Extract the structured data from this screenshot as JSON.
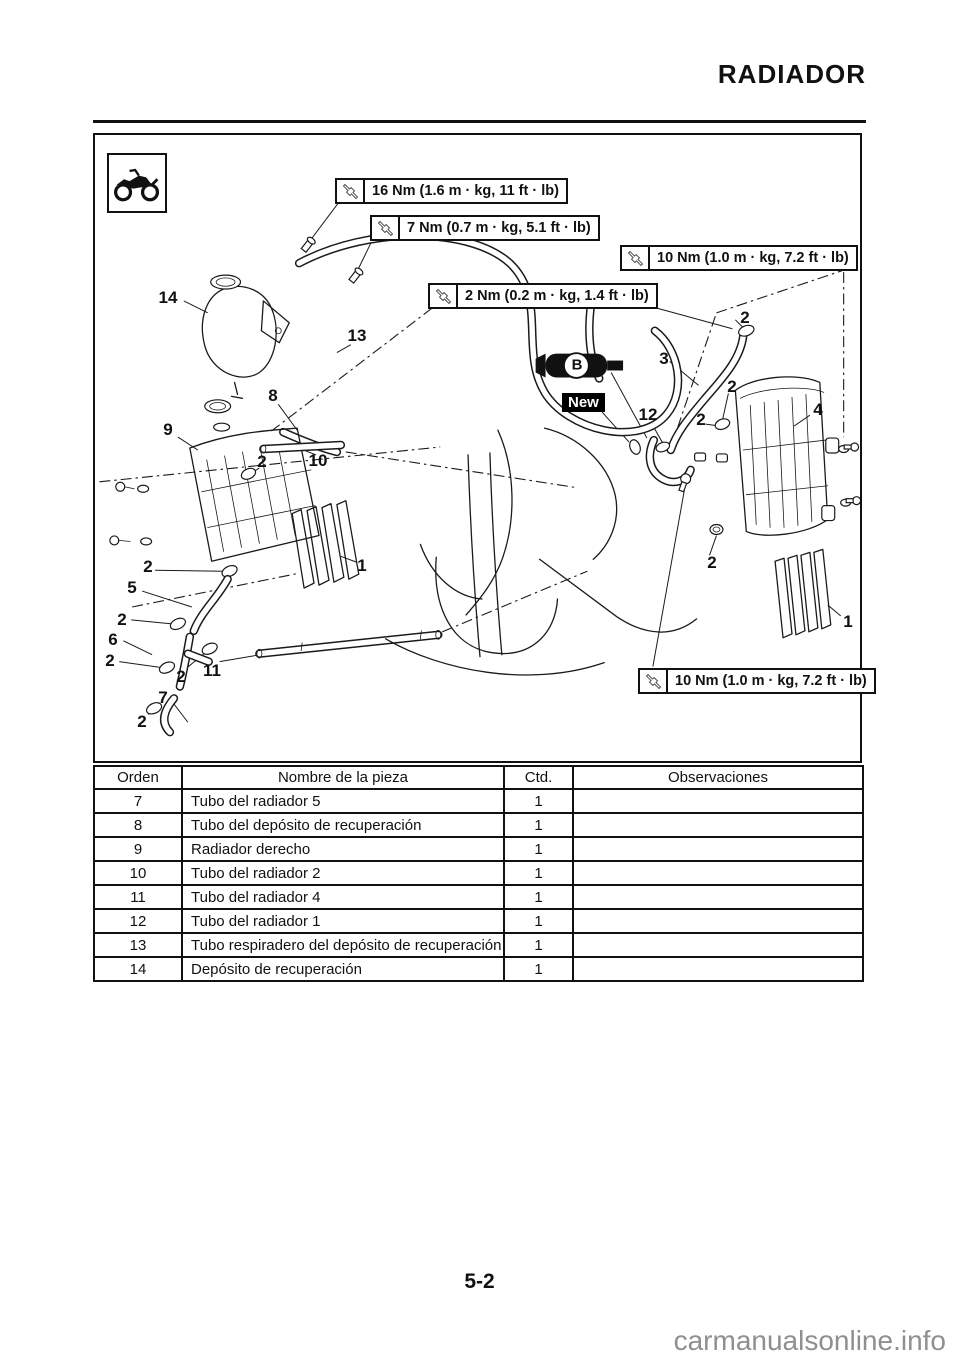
{
  "page": {
    "title": "RADIADOR",
    "number": "5-2",
    "watermark": "carmanualsonline.info"
  },
  "colors": {
    "ink": "#111111",
    "watermark_gray": "#8f8f8f"
  },
  "figure": {
    "torque_callouts": [
      "16 Nm (1.6 m · kg, 11 ft · lb)",
      "7 Nm (0.7 m · kg, 5.1 ft · lb)",
      "10 Nm (1.0 m · kg, 7.2 ft · lb)",
      "2 Nm (0.2 m · kg, 1.4 ft · lb)",
      "10 Nm (1.0 m · kg, 7.2 ft · lb)"
    ],
    "new_label": "New",
    "tool_symbol": "B",
    "part_labels": [
      {
        "n": "14",
        "x": 168,
        "y": 298
      },
      {
        "n": "13",
        "x": 357,
        "y": 336
      },
      {
        "n": "8",
        "x": 273,
        "y": 396
      },
      {
        "n": "9",
        "x": 168,
        "y": 430
      },
      {
        "n": "2",
        "x": 262,
        "y": 462
      },
      {
        "n": "10",
        "x": 318,
        "y": 461
      },
      {
        "n": "1",
        "x": 362,
        "y": 566
      },
      {
        "n": "2",
        "x": 148,
        "y": 567
      },
      {
        "n": "5",
        "x": 132,
        "y": 588
      },
      {
        "n": "2",
        "x": 122,
        "y": 620
      },
      {
        "n": "6",
        "x": 113,
        "y": 640
      },
      {
        "n": "2",
        "x": 110,
        "y": 661
      },
      {
        "n": "2",
        "x": 181,
        "y": 677
      },
      {
        "n": "11",
        "x": 212,
        "y": 671
      },
      {
        "n": "7",
        "x": 163,
        "y": 698
      },
      {
        "n": "2",
        "x": 142,
        "y": 722
      },
      {
        "n": "3",
        "x": 664,
        "y": 359
      },
      {
        "n": "12",
        "x": 648,
        "y": 415
      },
      {
        "n": "2",
        "x": 745,
        "y": 318
      },
      {
        "n": "2",
        "x": 732,
        "y": 387
      },
      {
        "n": "2",
        "x": 701,
        "y": 420
      },
      {
        "n": "4",
        "x": 818,
        "y": 410
      },
      {
        "n": "2",
        "x": 712,
        "y": 563
      },
      {
        "n": "1",
        "x": 848,
        "y": 622
      }
    ]
  },
  "table": {
    "headers": [
      "Orden",
      "Nombre de la pieza",
      "Ctd.",
      "Observaciones"
    ],
    "rows": [
      [
        "7",
        "Tubo del radiador 5",
        "1",
        ""
      ],
      [
        "8",
        "Tubo del depósito de recuperación",
        "1",
        ""
      ],
      [
        "9",
        "Radiador derecho",
        "1",
        ""
      ],
      [
        "10",
        "Tubo del radiador 2",
        "1",
        ""
      ],
      [
        "11",
        "Tubo del radiador 4",
        "1",
        ""
      ],
      [
        "12",
        "Tubo del radiador 1",
        "1",
        ""
      ],
      [
        "13",
        "Tubo respiradero del depósito de recuperación",
        "1",
        ""
      ],
      [
        "14",
        "Depósito de recuperación",
        "1",
        ""
      ]
    ]
  }
}
